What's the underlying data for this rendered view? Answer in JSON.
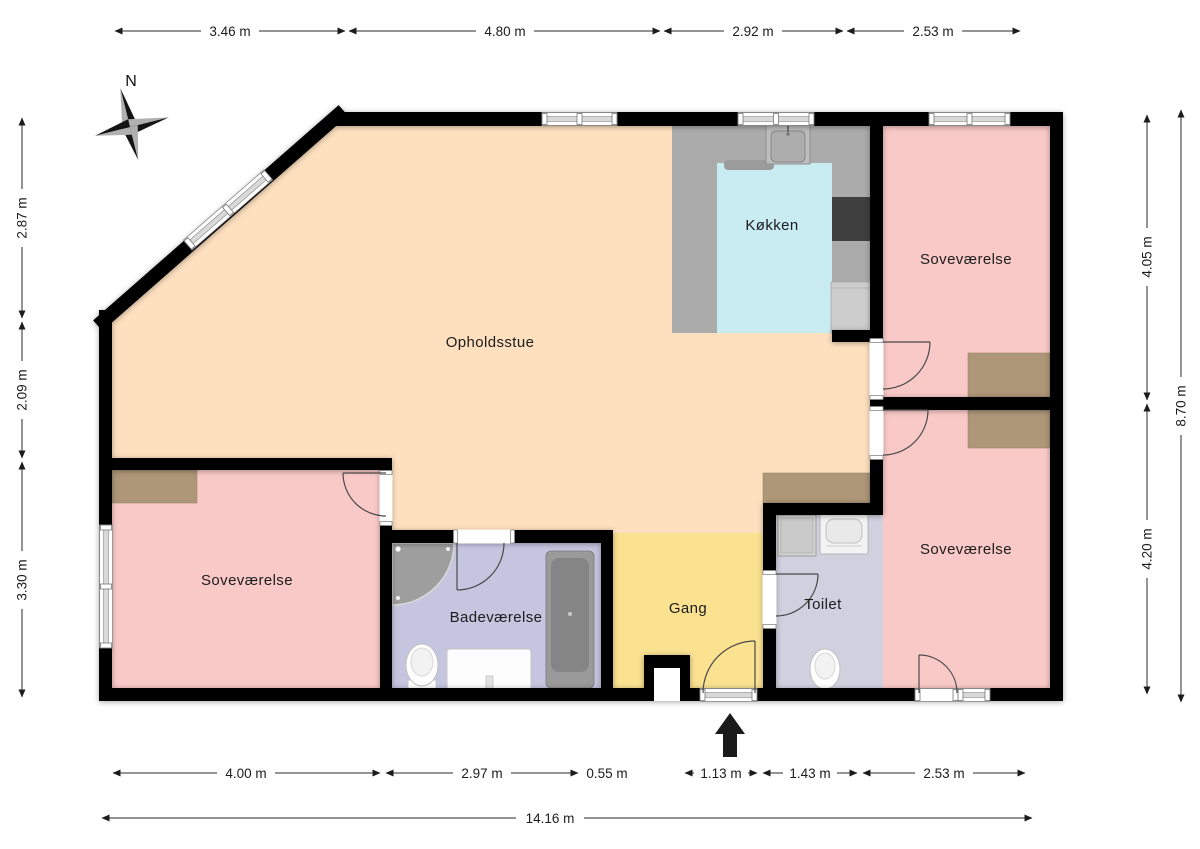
{
  "title": "Floor plan",
  "compass": {
    "north_label": "N"
  },
  "rooms": {
    "living": {
      "label": "Opholdsstue"
    },
    "kitchen": {
      "label": "Køkken"
    },
    "bedroom_ne": {
      "label": "Soveværelse"
    },
    "bedroom_se": {
      "label": "Soveværelse"
    },
    "bedroom_sw": {
      "label": "Soveværelse"
    },
    "bathroom": {
      "label": "Badeværelse"
    },
    "hallway": {
      "label": "Gang"
    },
    "toilet": {
      "label": "Toilet"
    }
  },
  "dimensions": {
    "top": [
      "3.46 m",
      "4.80 m",
      "2.92 m",
      "2.53 m"
    ],
    "left": [
      "2.87 m",
      "2.09 m",
      "3.30 m"
    ],
    "right_inner": [
      "4.05 m",
      "4.20 m"
    ],
    "right_outer": "8.70 m",
    "bottom": [
      "4.00 m",
      "2.97 m",
      "0.55 m",
      "1.13 m",
      "1.43 m",
      "2.53 m"
    ],
    "overall_width": "14.16 m"
  },
  "colors": {
    "wall": "#000000",
    "living": "#fee0bf",
    "bedroom": "#f9c9c7",
    "kitchen_floor": "#c9ecf3",
    "kitchen_counter": "#ababab",
    "bathroom": "#c5c5df",
    "toilet": "#d0d0df",
    "hallway": "#fae291",
    "wardrobe": "#ae9779"
  }
}
